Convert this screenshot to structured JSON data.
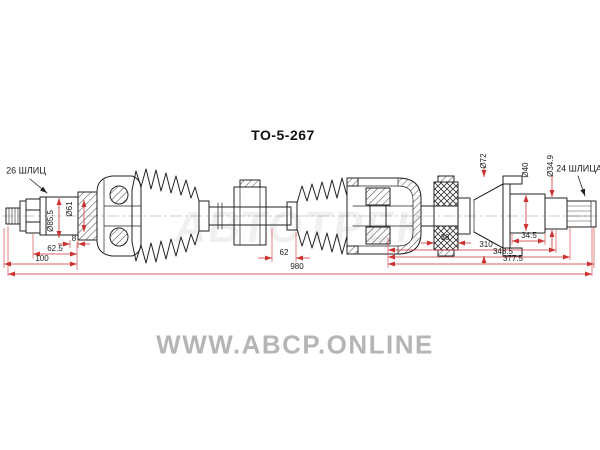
{
  "part_number": "TO-5-267",
  "spline_labels": {
    "left": "26 ШЛИЦ",
    "right": "24 ШЛИЦА"
  },
  "dims": {
    "d85_5": "Ø85.5",
    "d61": "Ø61",
    "w8": "8",
    "l62_5": "62.5",
    "l100": "100",
    "l62": "62",
    "l980": "980",
    "w36": "36",
    "d72": "Ø72",
    "d40": "Ø40",
    "d34_9": "Ø34.9",
    "l34_5": "34.5",
    "l310": "310",
    "l348_5": "348.5",
    "l377_5": "377.5"
  },
  "watermarks": {
    "brand": "АВТОТРЕК",
    "site": "WWW.ABCP.ONLINE"
  },
  "colors": {
    "dimension_red": "#cc3333",
    "line_black": "#222222",
    "watermark_gray": "#b5b5b5",
    "background": "#ffffff"
  }
}
